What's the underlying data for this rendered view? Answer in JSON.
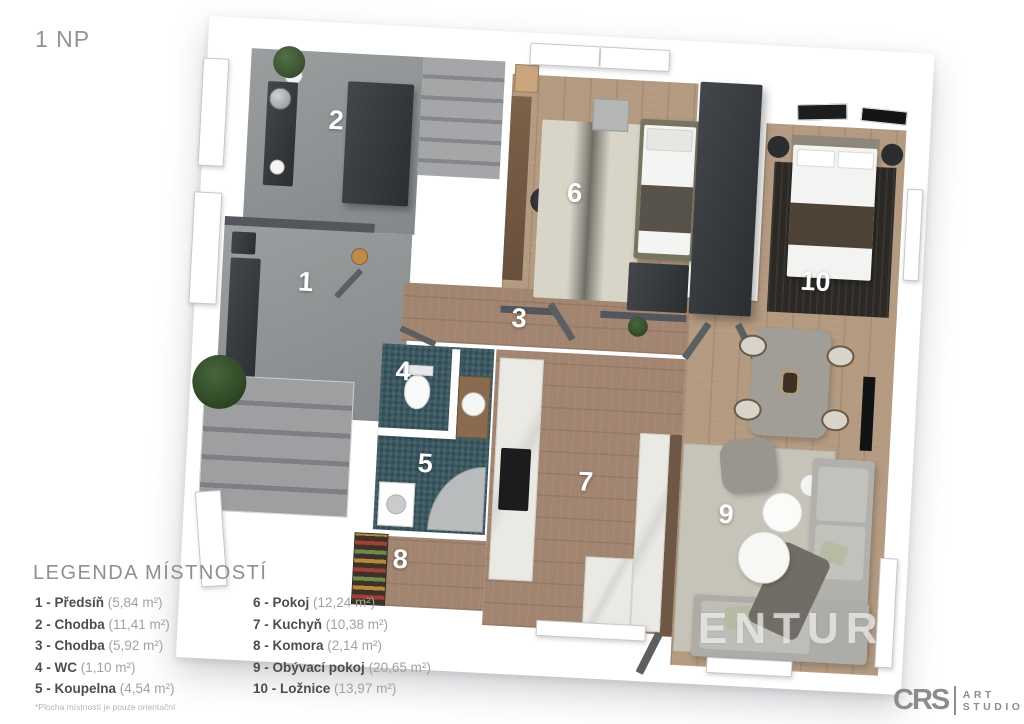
{
  "title": "1 NP",
  "legend": {
    "title": "LEGENDA MÍSTNOSTÍ",
    "columns": [
      {
        "items": [
          {
            "label": "1 - Předsíň",
            "area": "(5,84 m²)"
          },
          {
            "label": "2 - Chodba",
            "area": "(11,41 m²)"
          },
          {
            "label": "3 - Chodba",
            "area": "(5,92 m²)"
          },
          {
            "label": "4 - WC",
            "area": "(1,10 m²)"
          },
          {
            "label": "5 - Koupelna",
            "area": "(4,54 m²)"
          }
        ]
      },
      {
        "items": [
          {
            "label": "6 - Pokoj",
            "area": "(12,24 m²)"
          },
          {
            "label": "7 - Kuchyň",
            "area": "(10,38 m²)"
          },
          {
            "label": "8 - Komora",
            "area": "(2,14 m²)"
          },
          {
            "label": "9 - Obývací pokoj",
            "area": "(20,65 m²)"
          },
          {
            "label": "10 - Ložnice",
            "area": "(13,97 m²)"
          }
        ]
      }
    ]
  },
  "footnote": "*Plocha místností je pouze orientační",
  "watermark": "ENTUR",
  "logo": {
    "abbr": "CRS",
    "line1": "ART",
    "line2": "STUDIO"
  },
  "plan": {
    "rooms": [
      {
        "num": "1"
      },
      {
        "num": "2"
      },
      {
        "num": "3"
      },
      {
        "num": "4"
      },
      {
        "num": "5"
      },
      {
        "num": "6"
      },
      {
        "num": "7"
      },
      {
        "num": "8"
      },
      {
        "num": "9"
      },
      {
        "num": "10"
      }
    ]
  },
  "colors": {
    "wall": "#ffffff",
    "gray_floor": "#8f9294",
    "wood_floor": "#b39a81",
    "teal_floor": "#3a5862",
    "dark_furniture": "#3a3d41",
    "text_gray": "#8f8f8f",
    "label_white": "#ffffff"
  }
}
